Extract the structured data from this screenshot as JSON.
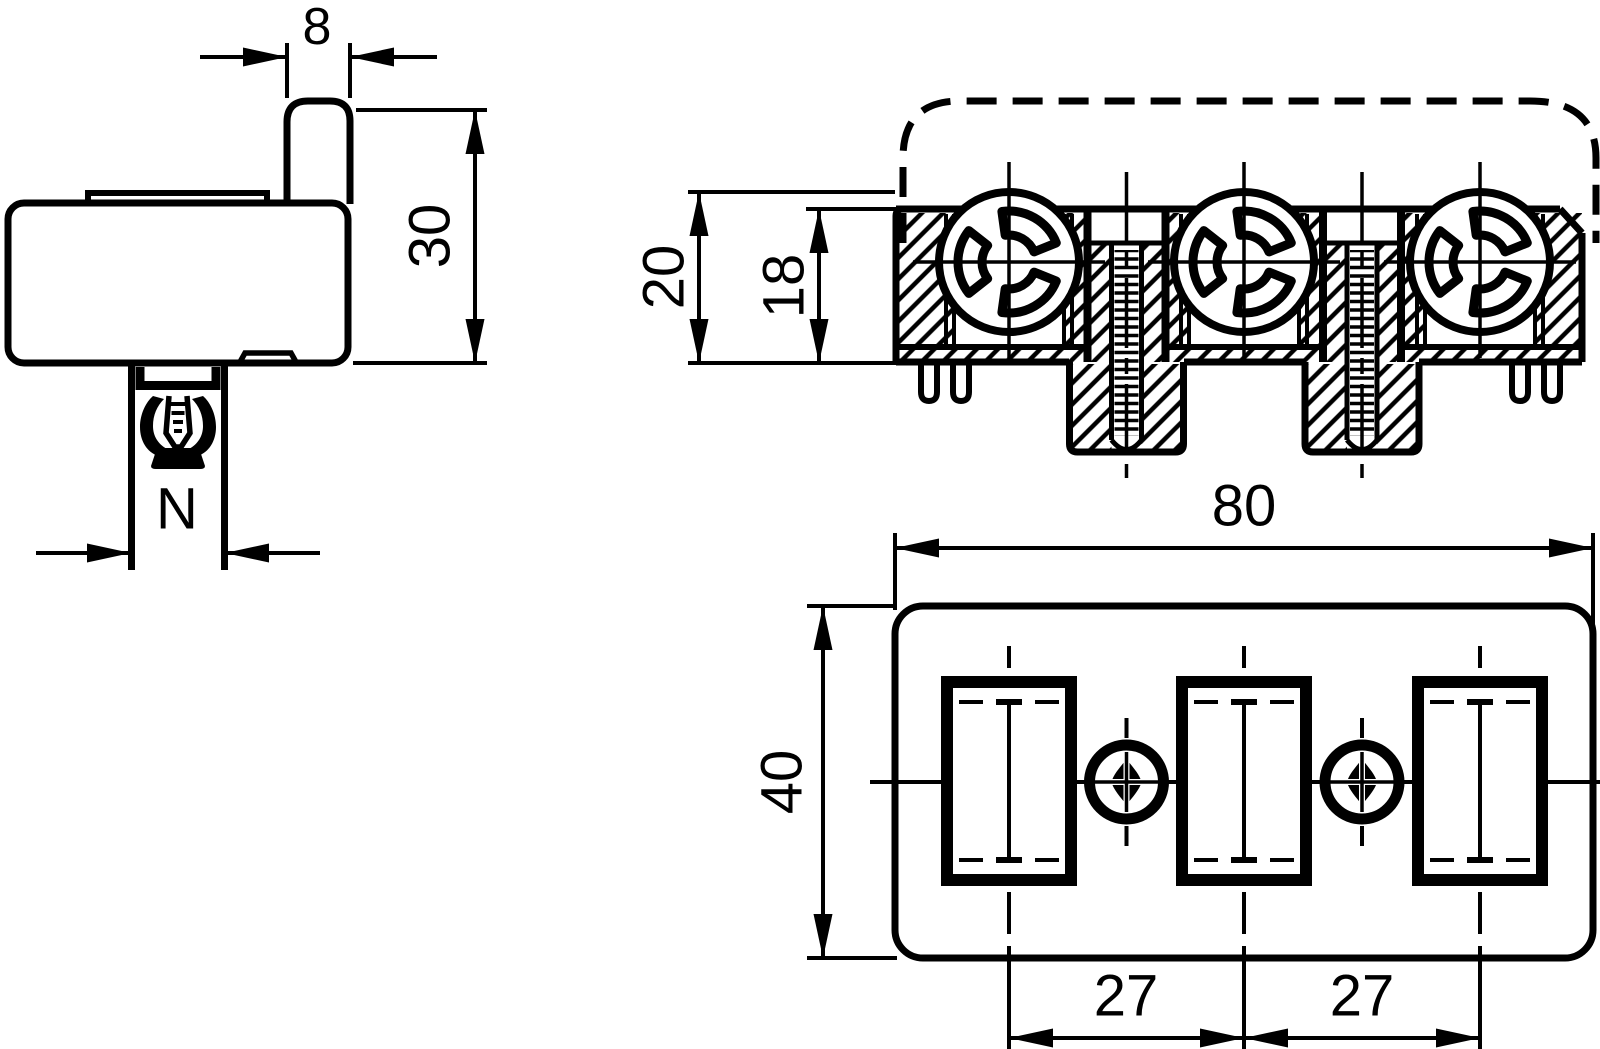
{
  "colors": {
    "line": "#000000",
    "background": "#ffffff"
  },
  "views": {
    "side": {
      "dimensions": {
        "tab_width": "8",
        "height": "30",
        "foot_width": "N"
      }
    },
    "front": {
      "dimensions": {
        "overall_height": "20",
        "body_height": "18"
      }
    },
    "bottom": {
      "dimensions": {
        "width": "80",
        "depth": "40",
        "pitch_left": "27",
        "pitch_right": "27"
      }
    }
  }
}
